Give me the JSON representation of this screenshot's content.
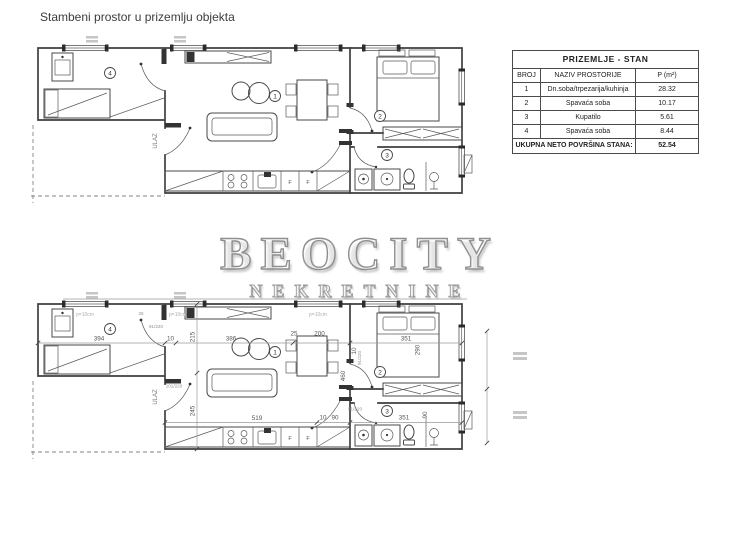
{
  "page": {
    "title": "Stambeni prostor u prizemlju objekta"
  },
  "watermark": {
    "brand": "BEOCITY",
    "subtitle": "NEKRETNINE"
  },
  "area_table": {
    "title": "PRIZEMLJE - STAN",
    "col_no": "BROJ",
    "col_name": "NAZIV PROSTORIJE",
    "col_area": "P (m²)",
    "rows": [
      {
        "no": "1",
        "name": "Dn.soba/trpezarija/kuhinja",
        "area": "28.32"
      },
      {
        "no": "2",
        "name": "Spavaća soba",
        "area": "10.17"
      },
      {
        "no": "3",
        "name": "Kupatilo",
        "area": "5.61"
      },
      {
        "no": "4",
        "name": "Spavaća soba",
        "area": "8.44"
      }
    ],
    "total_label": "UKUPNA NETO POVRŠINA STANA:",
    "total_value": "52.54"
  },
  "plan": {
    "rooms": [
      "1",
      "2",
      "3",
      "4"
    ],
    "entrance": "ULAZ",
    "fridge": "F"
  },
  "dims": {
    "w_room4": "394",
    "wall10": "10",
    "w_living": "386",
    "off25": "25",
    "t200": "200",
    "w_bedroom": "351",
    "bed290": "290",
    "h215": "215",
    "h245": "245",
    "h460": "460",
    "kitchen519": "519",
    "d90": "90",
    "w_bath": "351",
    "door91": "91/220",
    "door101": "101/220",
    "parapet": "p=10cm"
  }
}
